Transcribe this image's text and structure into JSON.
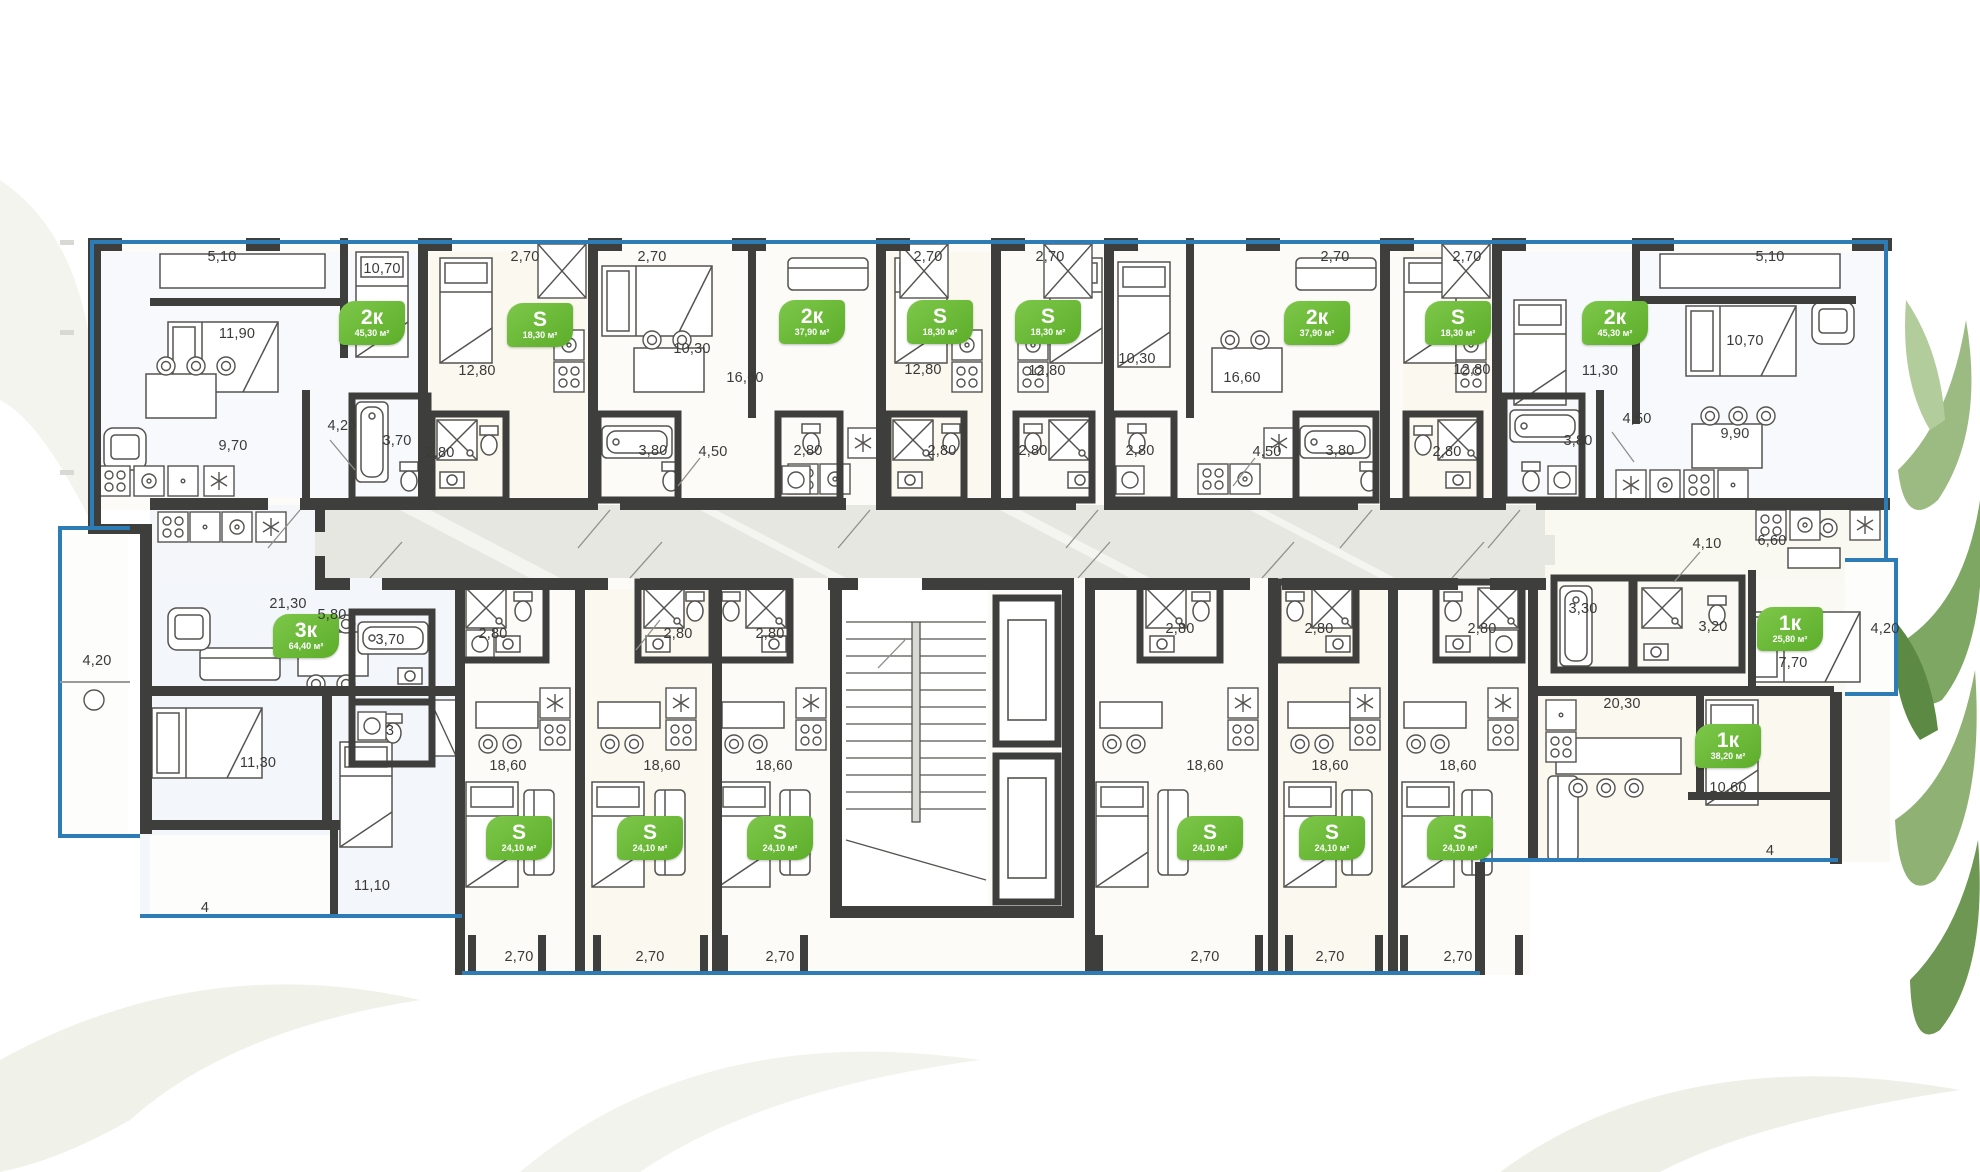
{
  "colors": {
    "wall": "#3e3e3c",
    "window_line": "#2e7cb6",
    "badge_green": "#6ab438",
    "corridor": "#e7e7e1",
    "leaf_green": "#8fb173"
  },
  "plan": {
    "badges": [
      {
        "label": "2к",
        "area": "45,30 м²",
        "x": 372,
        "y": 323
      },
      {
        "label": "S",
        "area": "18,30 м²",
        "x": 540,
        "y": 325
      },
      {
        "label": "2к",
        "area": "37,90 м²",
        "x": 812,
        "y": 322
      },
      {
        "label": "S",
        "area": "18,30 м²",
        "x": 940,
        "y": 322
      },
      {
        "label": "S",
        "area": "18,30 м²",
        "x": 1048,
        "y": 322
      },
      {
        "label": "2к",
        "area": "37,90 м²",
        "x": 1317,
        "y": 323
      },
      {
        "label": "S",
        "area": "18,30 м²",
        "x": 1458,
        "y": 323
      },
      {
        "label": "2к",
        "area": "45,30 м²",
        "x": 1615,
        "y": 323
      },
      {
        "label": "3к",
        "area": "64,40 м²",
        "x": 306,
        "y": 636
      },
      {
        "label": "S",
        "area": "24,10 м²",
        "x": 519,
        "y": 838
      },
      {
        "label": "S",
        "area": "24,10 м²",
        "x": 650,
        "y": 838
      },
      {
        "label": "S",
        "area": "24,10 м²",
        "x": 780,
        "y": 838
      },
      {
        "label": "S",
        "area": "24,10 м²",
        "x": 1210,
        "y": 838
      },
      {
        "label": "S",
        "area": "24,10 м²",
        "x": 1332,
        "y": 838
      },
      {
        "label": "S",
        "area": "24,10 м²",
        "x": 1460,
        "y": 838
      },
      {
        "label": "1к",
        "area": "25,80 м²",
        "x": 1790,
        "y": 629
      },
      {
        "label": "1к",
        "area": "38,20 м²",
        "x": 1728,
        "y": 746
      }
    ],
    "dims": [
      {
        "text": "5,10",
        "x": 222,
        "y": 257
      },
      {
        "text": "10,70",
        "x": 382,
        "y": 269
      },
      {
        "text": "11,90",
        "x": 237,
        "y": 334
      },
      {
        "text": "9,70",
        "x": 233,
        "y": 446
      },
      {
        "text": "4,20",
        "x": 342,
        "y": 426
      },
      {
        "text": "3,70",
        "x": 397,
        "y": 441
      },
      {
        "text": "2,70",
        "x": 525,
        "y": 257
      },
      {
        "text": "12,80",
        "x": 477,
        "y": 371
      },
      {
        "text": "2,80",
        "x": 440,
        "y": 453
      },
      {
        "text": "2,70",
        "x": 652,
        "y": 257
      },
      {
        "text": "10,30",
        "x": 692,
        "y": 349
      },
      {
        "text": "16,60",
        "x": 745,
        "y": 378
      },
      {
        "text": "3,80",
        "x": 653,
        "y": 451
      },
      {
        "text": "4,50",
        "x": 713,
        "y": 452
      },
      {
        "text": "2,80",
        "x": 808,
        "y": 451
      },
      {
        "text": "2,70",
        "x": 928,
        "y": 257
      },
      {
        "text": "12,80",
        "x": 923,
        "y": 370
      },
      {
        "text": "2,80",
        "x": 942,
        "y": 451
      },
      {
        "text": "2,70",
        "x": 1050,
        "y": 257
      },
      {
        "text": "12,80",
        "x": 1047,
        "y": 371
      },
      {
        "text": "2,80",
        "x": 1033,
        "y": 451
      },
      {
        "text": "2,70",
        "x": 1335,
        "y": 257
      },
      {
        "text": "10,30",
        "x": 1137,
        "y": 359
      },
      {
        "text": "16,60",
        "x": 1242,
        "y": 378
      },
      {
        "text": "2,80",
        "x": 1140,
        "y": 451
      },
      {
        "text": "4,50",
        "x": 1267,
        "y": 452
      },
      {
        "text": "3,80",
        "x": 1340,
        "y": 451
      },
      {
        "text": "2,70",
        "x": 1467,
        "y": 257
      },
      {
        "text": "12,80",
        "x": 1472,
        "y": 370
      },
      {
        "text": "2,80",
        "x": 1447,
        "y": 452
      },
      {
        "text": "5,10",
        "x": 1770,
        "y": 257
      },
      {
        "text": "10,70",
        "x": 1745,
        "y": 341
      },
      {
        "text": "11,30",
        "x": 1600,
        "y": 371
      },
      {
        "text": "4,50",
        "x": 1637,
        "y": 419
      },
      {
        "text": "3,80",
        "x": 1578,
        "y": 441
      },
      {
        "text": "9,90",
        "x": 1735,
        "y": 434
      },
      {
        "text": "4,20",
        "x": 97,
        "y": 661
      },
      {
        "text": "21,30",
        "x": 288,
        "y": 604
      },
      {
        "text": "5,80",
        "x": 332,
        "y": 615
      },
      {
        "text": "3,70",
        "x": 390,
        "y": 640
      },
      {
        "text": "3",
        "x": 390,
        "y": 731
      },
      {
        "text": "11,30",
        "x": 258,
        "y": 763
      },
      {
        "text": "11,10",
        "x": 372,
        "y": 886
      },
      {
        "text": "4",
        "x": 205,
        "y": 908
      },
      {
        "text": "2,80",
        "x": 493,
        "y": 634
      },
      {
        "text": "2,80",
        "x": 678,
        "y": 634
      },
      {
        "text": "2,80",
        "x": 770,
        "y": 634
      },
      {
        "text": "18,60",
        "x": 508,
        "y": 766
      },
      {
        "text": "18,60",
        "x": 662,
        "y": 766
      },
      {
        "text": "18,60",
        "x": 774,
        "y": 766
      },
      {
        "text": "2,70",
        "x": 519,
        "y": 957
      },
      {
        "text": "2,70",
        "x": 650,
        "y": 957
      },
      {
        "text": "2,70",
        "x": 780,
        "y": 957
      },
      {
        "text": "2,80",
        "x": 1180,
        "y": 629
      },
      {
        "text": "2,80",
        "x": 1319,
        "y": 629
      },
      {
        "text": "2,80",
        "x": 1482,
        "y": 629
      },
      {
        "text": "18,60",
        "x": 1205,
        "y": 766
      },
      {
        "text": "18,60",
        "x": 1330,
        "y": 766
      },
      {
        "text": "18,60",
        "x": 1458,
        "y": 766
      },
      {
        "text": "2,70",
        "x": 1205,
        "y": 957
      },
      {
        "text": "2,70",
        "x": 1330,
        "y": 957
      },
      {
        "text": "2,70",
        "x": 1458,
        "y": 957
      },
      {
        "text": "4,10",
        "x": 1707,
        "y": 544
      },
      {
        "text": "6,60",
        "x": 1772,
        "y": 541
      },
      {
        "text": "3,30",
        "x": 1583,
        "y": 609
      },
      {
        "text": "3,20",
        "x": 1713,
        "y": 627
      },
      {
        "text": "7,70",
        "x": 1793,
        "y": 663
      },
      {
        "text": "4,20",
        "x": 1885,
        "y": 629
      },
      {
        "text": "20,30",
        "x": 1622,
        "y": 704
      },
      {
        "text": "10,60",
        "x": 1728,
        "y": 788
      },
      {
        "text": "4",
        "x": 1770,
        "y": 851
      }
    ]
  }
}
